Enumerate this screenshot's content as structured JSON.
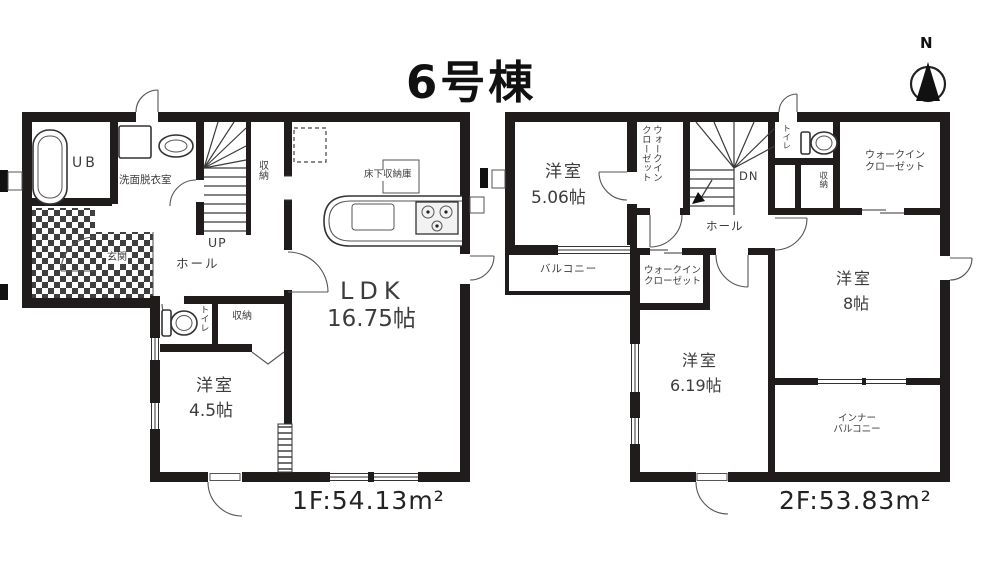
{
  "title": "6号棟",
  "compass": {
    "north": "N"
  },
  "colors": {
    "wall": "#201c1c",
    "line": "#3a3a3a",
    "text": "#3c3c3c",
    "background": "#ffffff"
  },
  "floor1": {
    "area": "1F:54.13m²",
    "rooms": {
      "ub": "UB",
      "washroom": "洗面脱衣室",
      "entrance": "玄関",
      "hall": "ホール",
      "stairs_up": "UP",
      "stair_storage": "収納",
      "underfloor_storage": "床下収納庫",
      "ldk_name": "LDK",
      "ldk_size": "16.75帖",
      "toilet": "トイレ",
      "closet": "収納",
      "bedroom_name": "洋室",
      "bedroom_size": "4.5帖"
    }
  },
  "floor2": {
    "area": "2F:53.83m²",
    "rooms": {
      "bedroom1_name": "洋室",
      "bedroom1_size": "5.06帖",
      "wic_west": "ウォークイン\nクローゼット",
      "stairs_down": "DN",
      "toilet": "トイレ",
      "storage": "収納",
      "wic_north": "ウォークイン\nクローゼット",
      "balcony": "バルコニー",
      "hall": "ホール",
      "wic_center": "ウォークイン\nクローゼット",
      "bedroom2_name": "洋室",
      "bedroom2_size": "8帖",
      "bedroom3_name": "洋室",
      "bedroom3_size": "6.19帖",
      "inner_balcony": "インナー\nバルコニー"
    }
  }
}
